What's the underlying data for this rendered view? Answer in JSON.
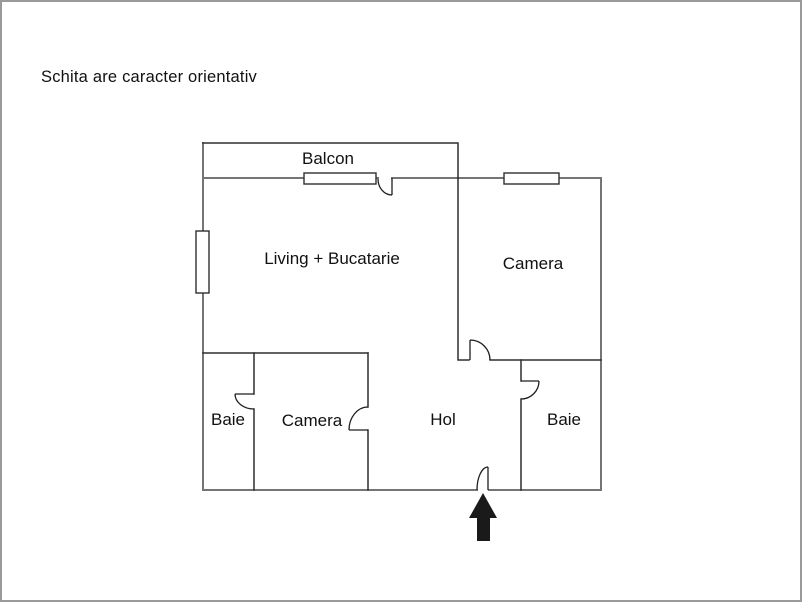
{
  "title": "Schita are caracter orientativ",
  "floorplan": {
    "rooms": [
      {
        "id": "balcon",
        "label": "Balcon"
      },
      {
        "id": "living",
        "label": "Living + Bucatarie"
      },
      {
        "id": "camera-top",
        "label": "Camera"
      },
      {
        "id": "baie-left",
        "label": "Baie"
      },
      {
        "id": "camera-bottom",
        "label": "Camera"
      },
      {
        "id": "hol",
        "label": "Hol"
      },
      {
        "id": "baie-right",
        "label": "Baie"
      }
    ],
    "icons": {
      "entrance_arrow": "up-arrow-entrance-marker"
    },
    "colors": {
      "frame": "#9a9a9a",
      "wall-outer": "#757575",
      "wall-inner": "#2f2f2f",
      "door": "#1f1f1f",
      "arrow": "#1a1a1a"
    }
  }
}
